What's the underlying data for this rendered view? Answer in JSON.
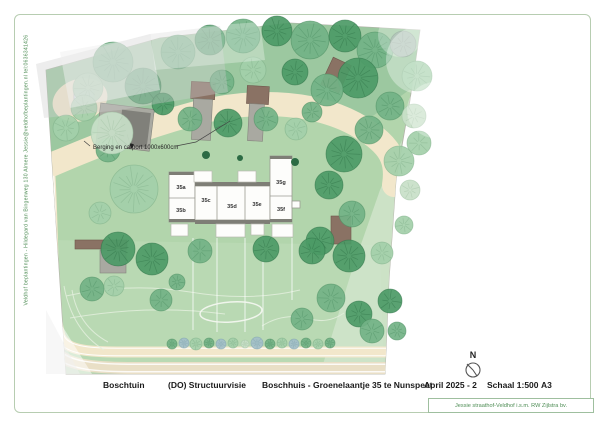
{
  "side_text": "Veldhof beplantingen - Hildegard van Bingenweg 130 Almere   Jessie@veldhofbeplantingen.nl   tel:0636341426",
  "annotations": {
    "berging_label": "Berging en carport 1000x600cm",
    "th_label": "TH"
  },
  "building": {
    "units": [
      {
        "label": "35a",
        "x": 181,
        "y": 189
      },
      {
        "label": "35b",
        "x": 181,
        "y": 212
      },
      {
        "label": "35c",
        "x": 206,
        "y": 202
      },
      {
        "label": "35d",
        "x": 232,
        "y": 208
      },
      {
        "label": "35e",
        "x": 257,
        "y": 206
      },
      {
        "label": "35f",
        "x": 281,
        "y": 211
      },
      {
        "label": "35g",
        "x": 281,
        "y": 184
      }
    ]
  },
  "titleblock": {
    "project": "Boschtuin",
    "phase": "(DO) Structuurvisie",
    "subject": "Boschhuis - Groenelaantje 35 te Nunspeet",
    "date": "April 2025 - 2",
    "scale": "Schaal 1:500",
    "paper": "A3",
    "north_label": "N",
    "credit": "Jessie straathof-Veldhof i.s.m. RW Zijlstra bv."
  },
  "colors": {
    "lawn": "#b2d5ac",
    "lawn_top": "#98c69e",
    "lawn_pale": "#d4e5cf",
    "path": "#f2e7cb",
    "road": "#e9dfc6",
    "building": "#fdfdfb",
    "roof": "#7e7e76",
    "shed_brown": "#8a7264",
    "shed_gray": "#a9a9a1",
    "frame": "#b7cdb1",
    "accent_text": "#4e8d55",
    "title_text": "#1a1a1a"
  },
  "plan": {
    "tree_palette": [
      {
        "fill": "#4c9a66",
        "line": "#2f7347"
      },
      {
        "fill": "#72b285",
        "line": "#4d8f63"
      },
      {
        "fill": "#a3cfa9",
        "line": "#7fb089"
      },
      {
        "fill": "#c8e0c8",
        "line": "#a3c4a6"
      },
      {
        "fill": "#93ab9c",
        "line": "#6f8a79"
      },
      {
        "fill": "#a3bfc9",
        "line": "#7fa3b0"
      }
    ],
    "trees": [
      [
        113,
        62,
        20,
        1
      ],
      [
        88,
        88,
        15,
        2
      ],
      [
        143,
        86,
        18,
        0
      ],
      [
        178,
        52,
        17,
        1
      ],
      [
        210,
        40,
        15,
        0
      ],
      [
        243,
        36,
        17,
        1
      ],
      [
        277,
        31,
        15,
        0
      ],
      [
        310,
        40,
        19,
        1
      ],
      [
        345,
        36,
        16,
        0
      ],
      [
        375,
        50,
        18,
        1
      ],
      [
        403,
        44,
        13,
        4
      ],
      [
        417,
        76,
        15,
        2
      ],
      [
        358,
        78,
        20,
        0
      ],
      [
        327,
        90,
        16,
        1
      ],
      [
        390,
        106,
        14,
        1
      ],
      [
        414,
        116,
        12,
        3
      ],
      [
        253,
        70,
        13,
        2
      ],
      [
        222,
        82,
        12,
        1
      ],
      [
        295,
        72,
        13,
        0
      ],
      [
        419,
        143,
        12,
        2
      ],
      [
        163,
        104,
        11,
        0
      ],
      [
        190,
        119,
        12,
        1
      ],
      [
        228,
        123,
        14,
        0
      ],
      [
        266,
        119,
        12,
        1
      ],
      [
        296,
        129,
        11,
        2
      ],
      [
        312,
        112,
        10,
        1
      ],
      [
        66,
        128,
        13,
        2
      ],
      [
        108,
        150,
        12,
        1
      ],
      [
        134,
        189,
        24,
        2
      ],
      [
        100,
        213,
        11,
        2
      ],
      [
        118,
        249,
        17,
        0
      ],
      [
        92,
        289,
        12,
        1
      ],
      [
        152,
        259,
        16,
        0
      ],
      [
        161,
        300,
        11,
        1
      ],
      [
        114,
        286,
        10,
        2
      ],
      [
        177,
        282,
        8,
        1
      ],
      [
        112,
        133,
        21,
        3
      ],
      [
        84,
        108,
        13,
        2
      ],
      [
        344,
        154,
        18,
        0
      ],
      [
        369,
        130,
        14,
        1
      ],
      [
        399,
        161,
        15,
        2
      ],
      [
        329,
        185,
        14,
        0
      ],
      [
        352,
        214,
        13,
        1
      ],
      [
        320,
        241,
        14,
        0
      ],
      [
        349,
        256,
        16,
        0
      ],
      [
        382,
        253,
        11,
        2
      ],
      [
        331,
        298,
        14,
        1
      ],
      [
        359,
        314,
        13,
        0
      ],
      [
        302,
        319,
        11,
        1
      ],
      [
        390,
        301,
        12,
        0
      ],
      [
        372,
        331,
        12,
        1
      ],
      [
        397,
        331,
        9,
        1
      ],
      [
        410,
        190,
        10,
        3
      ],
      [
        404,
        225,
        9,
        2
      ],
      [
        200,
        251,
        12,
        1
      ],
      [
        266,
        249,
        13,
        0
      ],
      [
        312,
        251,
        13,
        0
      ]
    ],
    "shrubs": [
      [
        172,
        344,
        5,
        1
      ],
      [
        184,
        343,
        5,
        5
      ],
      [
        196,
        344,
        6,
        2
      ],
      [
        209,
        343,
        5,
        1
      ],
      [
        221,
        344,
        5,
        5
      ],
      [
        233,
        343,
        5,
        2
      ],
      [
        245,
        344,
        4,
        3
      ],
      [
        257,
        343,
        6,
        5
      ],
      [
        270,
        344,
        5,
        1
      ],
      [
        282,
        343,
        5,
        2
      ],
      [
        294,
        344,
        5,
        5
      ],
      [
        306,
        343,
        5,
        1
      ],
      [
        318,
        344,
        5,
        2
      ],
      [
        330,
        343,
        5,
        1
      ]
    ],
    "conifers": [
      [
        206,
        155,
        4
      ],
      [
        240,
        158,
        3
      ],
      [
        295,
        162,
        4
      ]
    ]
  }
}
